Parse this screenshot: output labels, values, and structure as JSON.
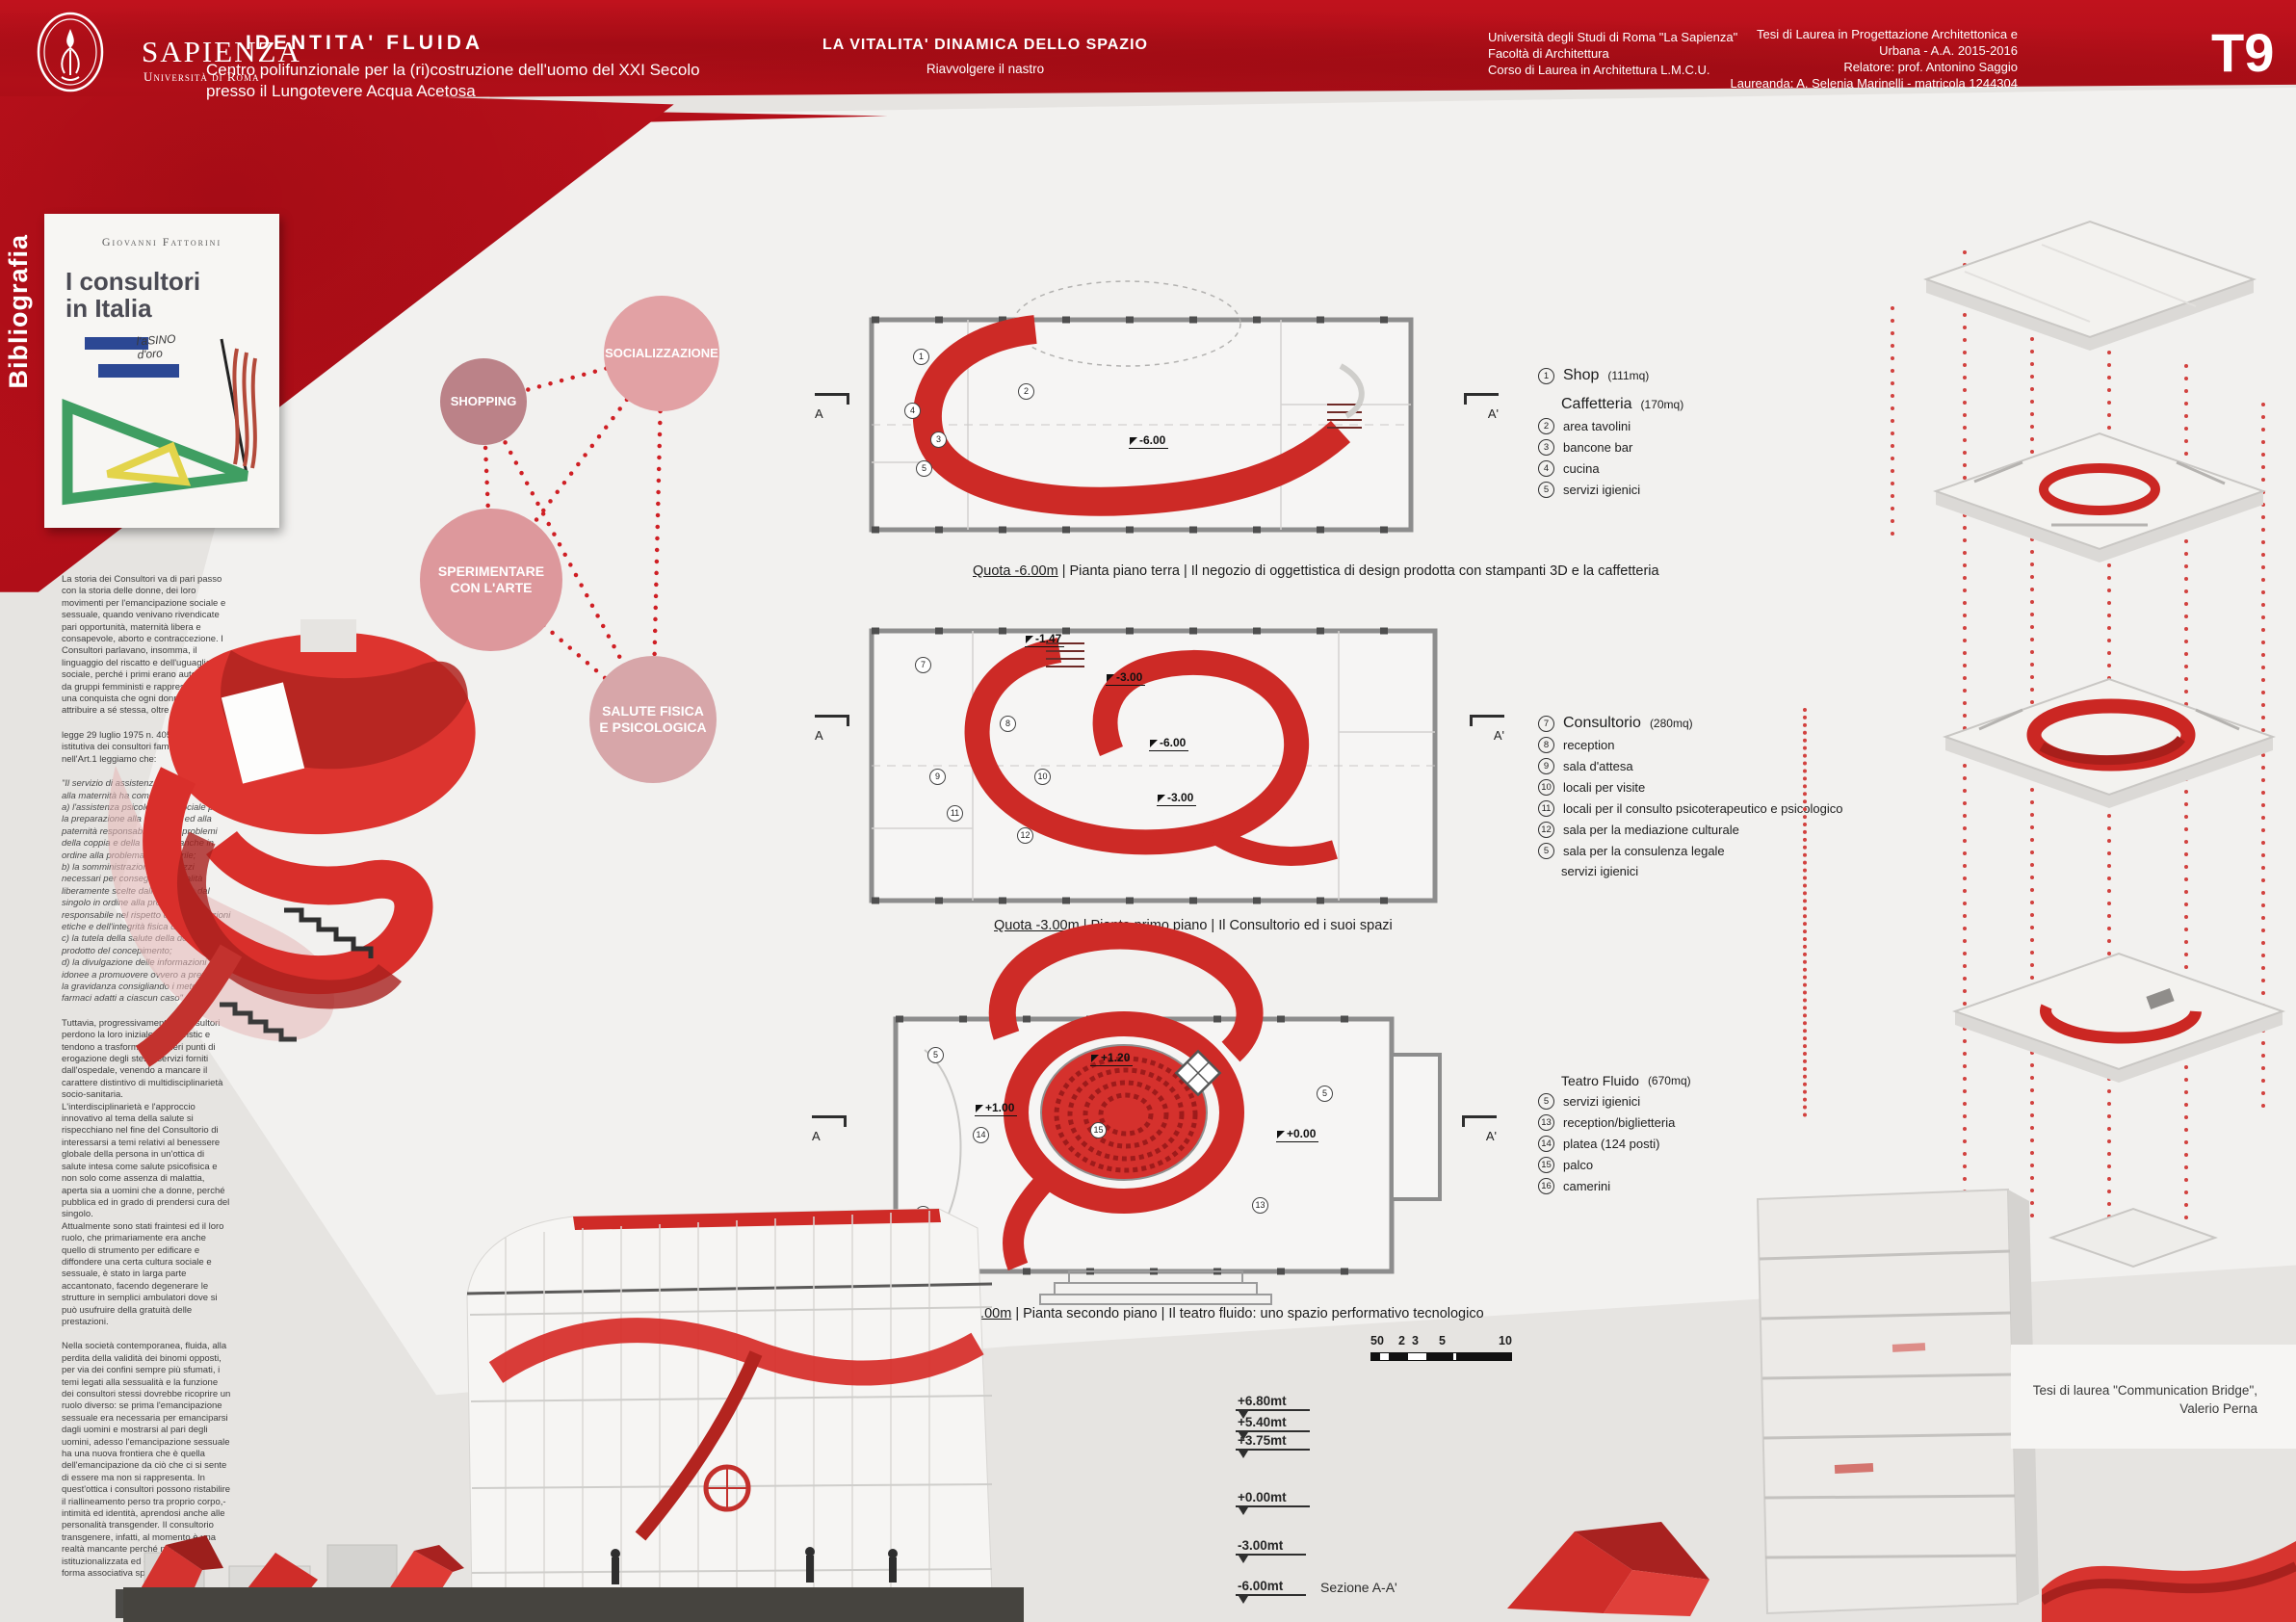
{
  "colors": {
    "accent_red": "#b90f1a",
    "plan_red": "#cd2a26",
    "dot_red": "#cf1f24"
  },
  "header": {
    "logo": {
      "name": "SAPIENZA",
      "subname": "Università di Roma"
    },
    "title": "IDENTITA' FLUIDA",
    "subtitle": "Centro polifunzionale per la (ri)costruzione dell'uomo del XXI Secolo\npresso il Lungotevere Acqua Acetosa",
    "center_title": "LA VITALITA' DINAMICA DELLO SPAZIO",
    "center_subtitle": "Riavvolgere il nastro",
    "university": "Università degli Studi di Roma \"La Sapienza\"\nFacoltà di Architettura\nCorso di Laurea in Architettura L.M.C.U.",
    "thesis": "Tesi di Laurea in Progettazione Architettonica e Urbana - A.A. 2015-2016\nRelatore: prof. Antonino Saggio\nLaureanda: A. Selenia Marinelli - matricola 1244304",
    "panel": "T9"
  },
  "sidebar": {
    "label": "Bibliografia",
    "book": {
      "author": "Giovanni Fattorini",
      "title": "I consultori\nin Italia",
      "scribble": "l'aSINO\nd'oro"
    },
    "p1": "La storia dei Consultori va di pari passo con la storia delle donne, dei loro movimenti per l'emancipazione sociale e sessuale, quando venivano rivendicate pari opportunità, maternità libera e consapevole, aborto e contraccezione. I Consultori parlavano, insomma, il linguaggio del riscatto e dell'uguaglianza sociale, perché i primi erano autogestiti da gruppi femministi e rappresentavano una conquista che ogni donna poteva attribuire a sé stessa, oltre che agli altri.",
    "p2": "legge 29 luglio 1975 n. 405: legge istitutiva dei consultori familiari\nnell'Art.1 leggiamo che:",
    "quote": "\"Il servizio di assistenza alla famiglia e alla maternità ha come scopi:\na) l'assistenza psicologica e sociale per la preparazione alla maternità ed alla paternità responsabile e per i problemi della coppia e della famiglia, anche in ordine alla problematica minorile;\nb) la somministrazione dei mezzi necessari per conseguire le finalità liberamente scelte dalla coppia e dal singolo in ordine alla procreazione responsabile nel rispetto delle convinzioni etiche e dell'integrità fisica degli utenti;\nc) la tutela della salute della donna e del prodotto del concepimento;\nd) la divulgazione delle informazioni idonee a promuovere ovvero a prevenire la gravidanza consigliando i metodi ed i farmaci adatti a ciascun caso\".",
    "p3": "Tuttavia, progressivamente i Consultori perdono la loro iniziale caratteristic e tendono a trasformarsi in meri punti di erogazione degli stessi servizi forniti dall'ospedale, venendo a mancare il carattere distintivo di multidisciplinarietà socio-sanitaria.\nL'interdisciplinarietà e l'approccio innovativo al tema della salute si rispecchiano nel fine del Consultorio di interessarsi a temi relativi al benessere globale della persona in un'ottica di salute intesa come salute psicofisica e non solo come assenza di malattia, aperta sia a uomini che a donne, perché pubblica ed in grado di prendersi cura del singolo.\nAttualmente sono stati fraintesi ed il loro ruolo, che primariamente era anche quello di strumento per edificare e diffondere una certa cultura sociale e sessuale, è stato in larga parte accantonato, facendo degenerare le strutture in semplici ambulatori dove si può usufruire della gratuità delle prestazioni.",
    "p4": "Nella società contemporanea, fluida, alla perdita della validità dei binomi opposti, per via dei confini sempre più sfumati, i temi legati alla sessualità e la funzione dei consultori stessi dovrebbe ricoprire un ruolo diverso: se prima l'emancipazione sessuale era necessaria per emanciparsi dagli uomini e mostrarsi al pari degli uomini, adesso l'emancipazione sessuale ha una nuova frontiera che è quella dell'emancipazione da ciò che ci si sente di essere ma non si rappresenta. In quest'ottica i consultori possono ristabilire il riallineamento perso tra proprio corpo,-intimità ed identità, aprendosi anche alle personalità transgender.  Il consultorio transgenere, infatti, al momento è una realtà mancante perché non istituzionalizzata ed esiste solo come forma associativa spontanea."
  },
  "bubbles": {
    "shopping": "SHOPPING",
    "socializzazione": "SOCIALIZZAZIONE",
    "sperimentare": "SPERIMENTARE\nCON L'ARTE",
    "salute": "SALUTE FISICA\nE PSICOLOGICA"
  },
  "plans": [
    {
      "caption_quota": "Quota -6.00m",
      "caption_rest": " | Pianta piano terra | Il negozio di oggettistica di design prodotta con stampanti 3D e la caffetteria",
      "annotations": [
        "-6.00"
      ],
      "nums": [
        "1",
        "2",
        "4",
        "3",
        "5"
      ]
    },
    {
      "caption_quota": "Quota -3.00m",
      "caption_rest": " | Pianta primo piano | Il Consultorio ed i suoi spazi",
      "annotations": [
        "-1.47",
        "-3.00",
        "-6.00",
        "-3.00"
      ],
      "nums": [
        "7",
        "8",
        "9",
        "10",
        "11",
        "12"
      ]
    },
    {
      "caption_quota": "Quota +0.00m",
      "caption_rest": " | Pianta secondo piano | Il teatro fluido:  uno spazio performativo tecnologico",
      "annotations": [
        "+1.20",
        "+1.00",
        "+0.00"
      ],
      "nums": [
        "5",
        "15",
        "16",
        "14",
        "13",
        "5"
      ]
    }
  ],
  "section_markers": {
    "left": "A",
    "right": "A'"
  },
  "legends": [
    {
      "num": "1",
      "title": "Shop",
      "size": "(111mq)",
      "sub_title": "Caffetteria",
      "sub_size": "(170mq)",
      "items": [
        {
          "n": "2",
          "label": "area tavolini"
        },
        {
          "n": "3",
          "label": "bancone bar"
        },
        {
          "n": "4",
          "label": "cucina"
        },
        {
          "n": "5",
          "label": "servizi igienici"
        }
      ]
    },
    {
      "num": "7",
      "title": "Consultorio",
      "size": "(280mq)",
      "items": [
        {
          "n": "8",
          "label": "reception"
        },
        {
          "n": "9",
          "label": "sala d'attesa"
        },
        {
          "n": "10",
          "label": "locali per visite"
        },
        {
          "n": "11",
          "label": "locali per il consulto psicoterapeutico e psicologico"
        },
        {
          "n": "12",
          "label": "sala per la mediazione culturale"
        },
        {
          "n": "5",
          "label": "sala per la consulenza legale"
        },
        {
          "n": "",
          "label": "servizi igienici"
        }
      ]
    },
    {
      "num": "",
      "title": "Teatro Fluido",
      "size": "(670mq)",
      "items": [
        {
          "n": "5",
          "label": "servizi igienici"
        },
        {
          "n": "13",
          "label": "reception/biglietteria"
        },
        {
          "n": "14",
          "label": "platea (124 posti)"
        },
        {
          "n": "15",
          "label": "palco"
        },
        {
          "n": "16",
          "label": "camerini"
        }
      ]
    }
  ],
  "section": {
    "levels": [
      "+6.80mt",
      "+5.40mt",
      "+3.75mt",
      "+0.00mt",
      "-3.00mt",
      "-6.00mt"
    ],
    "label": "Sezione A-A'",
    "scale": [
      "50",
      "2",
      "3",
      "5",
      "10"
    ]
  },
  "credit": "Tesi di laurea  \"Communication Bridge\",\nValerio Perna"
}
